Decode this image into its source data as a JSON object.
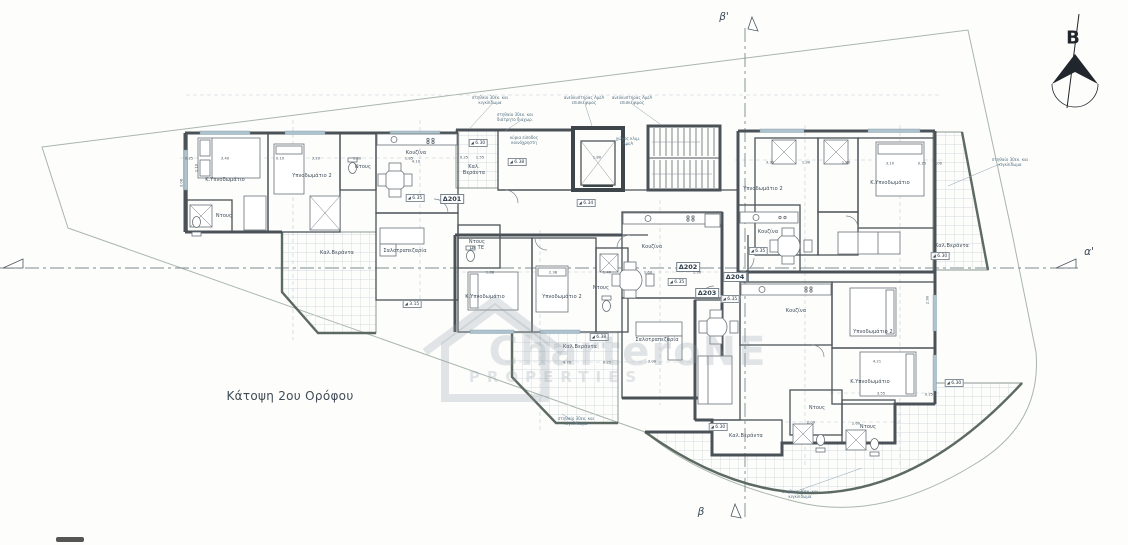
{
  "meta": {
    "title": "Κάτοψη 2ου Ορόφου",
    "north_label": "B"
  },
  "section_markers": {
    "top": "β'",
    "bottom": "β",
    "right": "α'"
  },
  "watermark": {
    "line1": "CharteroNE",
    "line2": "PROPERTIES"
  },
  "plan": {
    "apartment_ids": [
      {
        "t": "Δ201",
        "x": 452,
        "y": 199
      },
      {
        "t": "Δ202",
        "x": 688,
        "y": 267
      },
      {
        "t": "Δ203",
        "x": 707,
        "y": 293
      },
      {
        "t": "Δ204",
        "x": 735,
        "y": 277
      }
    ],
    "room_labels": [
      {
        "t": "Κ.Υπνοδωμάτιο",
        "x": 225,
        "y": 180
      },
      {
        "t": "Υπνοδωμάτιο 2",
        "x": 312,
        "y": 176
      },
      {
        "t": "Ντους",
        "x": 224,
        "y": 216
      },
      {
        "t": "Ντους",
        "x": 363,
        "y": 167
      },
      {
        "t": "Κουζίνα",
        "x": 416,
        "y": 153
      },
      {
        "t": "Καλ.Βεράντα",
        "x": 337,
        "y": 253
      },
      {
        "t": "Σαλοτραπεζαρία",
        "x": 405,
        "y": 251
      },
      {
        "t": "Καλ.\nΒεράντα",
        "x": 474,
        "y": 170
      },
      {
        "t": "Ντους\nμε ΤΕ",
        "x": 477,
        "y": 245
      },
      {
        "t": "Κ.Υπνοδωμάτιο",
        "x": 485,
        "y": 297
      },
      {
        "t": "Υπνοδωμάτιο 2",
        "x": 562,
        "y": 297
      },
      {
        "t": "Ντους",
        "x": 601,
        "y": 288
      },
      {
        "t": "Κουζίνα",
        "x": 652,
        "y": 247
      },
      {
        "t": "Σαλοτραπεζαρία",
        "x": 657,
        "y": 340
      },
      {
        "t": "Καλ.Βεράντα",
        "x": 580,
        "y": 347
      },
      {
        "t": "Υπνοδωμάτιο 2",
        "x": 763,
        "y": 189
      },
      {
        "t": "Κ.Υπνοδωμάτιο",
        "x": 890,
        "y": 183
      },
      {
        "t": "Κουζίνα",
        "x": 768,
        "y": 232
      },
      {
        "t": "Καλ.Βεράντα",
        "x": 952,
        "y": 246
      },
      {
        "t": "Κουζίνα",
        "x": 796,
        "y": 311
      },
      {
        "t": "Υπνοδωμάτιο 2",
        "x": 873,
        "y": 332
      },
      {
        "t": "Κ.Υπνοδωμάτιο",
        "x": 870,
        "y": 382
      },
      {
        "t": "Ντους",
        "x": 817,
        "y": 408
      },
      {
        "t": "Ντους",
        "x": 868,
        "y": 427
      },
      {
        "t": "Καλ.Βεράντα",
        "x": 746,
        "y": 436
      }
    ],
    "levels": [
      {
        "v": "6.30",
        "x": 478,
        "y": 143
      },
      {
        "v": "6.38",
        "x": 517,
        "y": 162
      },
      {
        "v": "6.34",
        "x": 586,
        "y": 203
      },
      {
        "v": "6.35",
        "x": 415,
        "y": 198
      },
      {
        "v": "3.15",
        "x": 412,
        "y": 304
      },
      {
        "v": "6.35",
        "x": 677,
        "y": 282
      },
      {
        "v": "6.38",
        "x": 599,
        "y": 337
      },
      {
        "v": "6.35",
        "x": 758,
        "y": 251
      },
      {
        "v": "6.35",
        "x": 730,
        "y": 299
      },
      {
        "v": "6.30",
        "x": 940,
        "y": 256
      },
      {
        "v": "6.30",
        "x": 718,
        "y": 427
      },
      {
        "v": "6.30",
        "x": 954,
        "y": 383
      }
    ],
    "annotations": [
      {
        "t": "στηθαίο 30εκ. και\nκιγκλίδωμα",
        "x": 490,
        "y": 100
      },
      {
        "t": "στηθαίο 30εκ. και\nδιάτρητο διαχωρ.",
        "x": 515,
        "y": 117
      },
      {
        "t": "ανελκυστήρας ΑμεΑ\nεπισκέψιμος",
        "x": 584,
        "y": 100
      },
      {
        "t": "ανελκυστήρας ΑμεΑ\nεπισκέψιμος",
        "x": 632,
        "y": 100
      },
      {
        "t": "κύρια είσοδος\nκοινόχρηστη",
        "x": 524,
        "y": 140
      },
      {
        "t": "χώρος κλιμ.\nΑμεΑ",
        "x": 628,
        "y": 141
      },
      {
        "t": "στηθαίο 30εκ. και\nκιγκλίδωμα",
        "x": 576,
        "y": 421
      },
      {
        "t": "στηθαίο 30εκ. και\nκιγκλίδωμα",
        "x": 800,
        "y": 494
      },
      {
        "t": "στηθαίο 30εκ. και\nκιγκλίδωμα",
        "x": 1010,
        "y": 162
      }
    ],
    "dimensions": [
      {
        "t": "0.25",
        "x": 189,
        "y": 158
      },
      {
        "t": "3.40",
        "x": 225,
        "y": 158
      },
      {
        "t": "0.10",
        "x": 280,
        "y": 158
      },
      {
        "t": "3.20",
        "x": 316,
        "y": 158
      },
      {
        "t": "1.80",
        "x": 357,
        "y": 158
      },
      {
        "t": "1.85",
        "x": 409,
        "y": 158
      },
      {
        "t": "4.10",
        "x": 416,
        "y": 161
      },
      {
        "t": "0.25",
        "x": 464,
        "y": 157
      },
      {
        "t": "1.55",
        "x": 480,
        "y": 157
      },
      {
        "t": "1.80",
        "x": 597,
        "y": 157
      },
      {
        "t": "3.30",
        "x": 770,
        "y": 162
      },
      {
        "t": "1.30",
        "x": 806,
        "y": 162
      },
      {
        "t": "1.80",
        "x": 846,
        "y": 162
      },
      {
        "t": "3.10",
        "x": 890,
        "y": 163
      },
      {
        "t": "0.25",
        "x": 922,
        "y": 163
      },
      {
        "t": "1.00",
        "x": 938,
        "y": 163
      },
      {
        "t": "1.88",
        "x": 490,
        "y": 272
      },
      {
        "t": "2.38",
        "x": 553,
        "y": 272
      },
      {
        "t": "1.40",
        "x": 607,
        "y": 272
      },
      {
        "t": "1.60",
        "x": 648,
        "y": 272
      },
      {
        "t": "1.30",
        "x": 697,
        "y": 272
      },
      {
        "t": "4.70",
        "x": 567,
        "y": 362
      },
      {
        "t": "0.25",
        "x": 607,
        "y": 362
      },
      {
        "t": "3.00",
        "x": 652,
        "y": 361
      },
      {
        "t": "4.21",
        "x": 877,
        "y": 361
      },
      {
        "t": "3.55",
        "x": 881,
        "y": 393
      },
      {
        "t": "0.25",
        "x": 929,
        "y": 394
      },
      {
        "t": "2.00",
        "x": 811,
        "y": 422
      },
      {
        "t": "2.60",
        "x": 856,
        "y": 423
      },
      {
        "t": "3.08",
        "x": 181,
        "y": 183,
        "r": 90
      },
      {
        "t": "1.10",
        "x": 196,
        "y": 168,
        "r": 90
      },
      {
        "t": "2.90",
        "x": 927,
        "y": 300,
        "r": 90
      }
    ]
  }
}
